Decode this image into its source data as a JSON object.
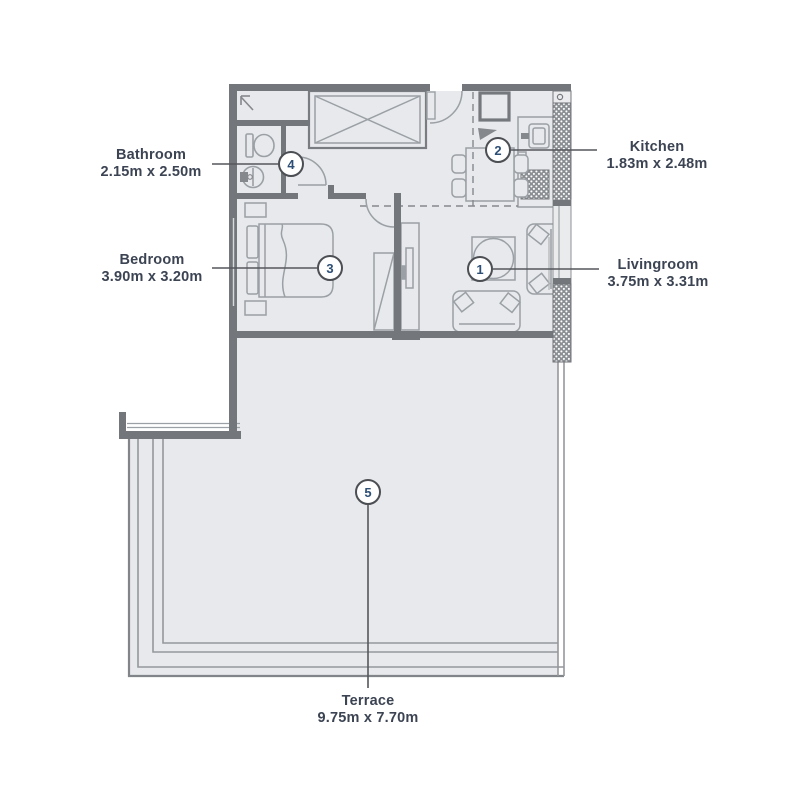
{
  "plan": {
    "type": "apartment-floor-plan",
    "rooms": [
      {
        "number": "1",
        "name": "Livingroom",
        "size": "3.75m x 3.31m"
      },
      {
        "number": "2",
        "name": "Kitchen",
        "size": "1.83m x 2.48m"
      },
      {
        "number": "3",
        "name": "Bedroom",
        "size": "3.90m x 3.20m"
      },
      {
        "number": "4",
        "name": "Bathroom",
        "size": "2.15m x 2.50m"
      },
      {
        "number": "5",
        "name": "Terrace",
        "size": "9.75m x 7.70m"
      }
    ],
    "colors": {
      "wall": "#73767b",
      "floor": "#e8e9ec",
      "furniture_line": "#9aa0a5",
      "label_text": "#3c4453",
      "marker_number": "#2d4f76",
      "leader_line": "#54575c"
    }
  }
}
